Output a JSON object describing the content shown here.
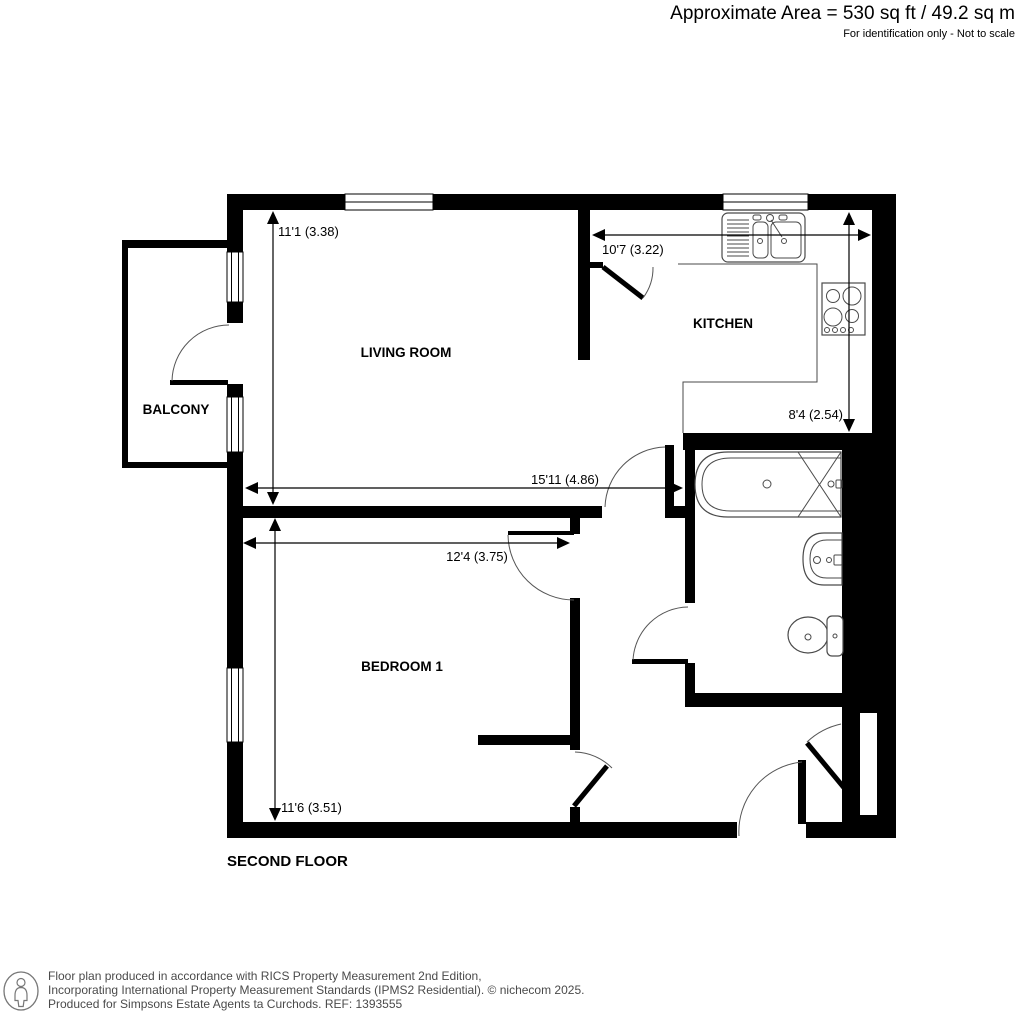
{
  "header": {
    "area": "Approximate Area = 530 sq ft / 49.2 sq m",
    "note": "For identification only - Not to scale"
  },
  "rooms": {
    "living": "LIVING ROOM",
    "kitchen": "KITCHEN",
    "balcony": "BALCONY",
    "bedroom": "BEDROOM 1"
  },
  "dimensions": {
    "living_depth": "11'1 (3.38)",
    "kitchen_width": "10'7 (3.22)",
    "kitchen_depth": "8'4 (2.54)",
    "living_width": "15'11 (4.86)",
    "bedroom_width": "12'4 (3.75)",
    "bedroom_depth": "11'6 (3.51)"
  },
  "floor_label": "SECOND FLOOR",
  "footer": {
    "line1": "Floor plan produced in accordance with RICS Property Measurement 2nd Edition,",
    "line2": "Incorporating International Property Measurement Standards (IPMS2 Residential).   © nichecom 2025.",
    "line3": "Produced for Simpsons Estate Agents ta Curchods.   REF: 1393555"
  },
  "colors": {
    "wall": "#000000",
    "fixture_line": "#4a4a4a",
    "background": "#ffffff"
  }
}
